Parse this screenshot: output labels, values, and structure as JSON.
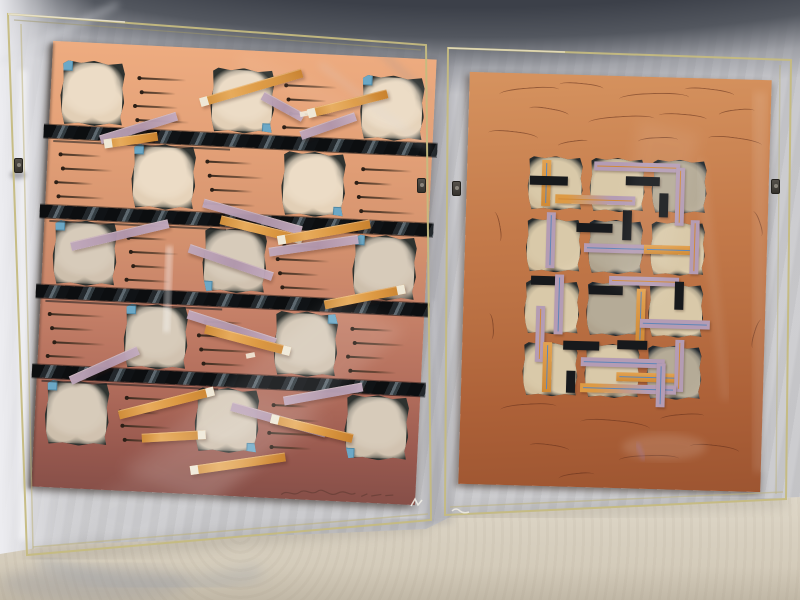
{
  "scene": {
    "description": "Photograph of two abstract mixed-media collage artworks in clear acrylic box frames standing side by side on a cream table against a draped gray fabric backdrop",
    "artwork_count": 2,
    "palette": {
      "fabric": "#c6c6ca",
      "fabric_shadow": "#4a4e56",
      "table": "#d8d0c0",
      "acrylic_edge": "#c5bb80",
      "clip_metal": "#3f3c38"
    }
  },
  "left_artwork": {
    "style": "salmon-to-maroon gradient paper, checkerboard grid of dark textured collage squares with sky-blue corner tabs, four black striped bars, scattered diagonal orange and lavender paper strips, scribbled ink lines",
    "paper_gradient": [
      "#eeac80",
      "#d6946f",
      "#b06c5b",
      "#864f48"
    ],
    "grid": {
      "rows": 5,
      "cols": 5,
      "square_color": "#2e322f",
      "texture_color": "#ecdcc6",
      "pattern": [
        [
          1,
          0,
          1,
          0,
          1
        ],
        [
          0,
          1,
          0,
          1,
          0
        ],
        [
          1,
          0,
          1,
          0,
          1
        ],
        [
          0,
          1,
          0,
          1,
          0
        ],
        [
          1,
          0,
          1,
          0,
          1
        ]
      ]
    },
    "blue_squares": {
      "color": "#6ca8c6",
      "positions": [
        {
          "r": 0,
          "c": 0,
          "corner": "tl"
        },
        {
          "r": 0,
          "c": 2,
          "corner": "br"
        },
        {
          "r": 0,
          "c": 4,
          "corner": "tl"
        },
        {
          "r": 1,
          "c": 1,
          "corner": "tl"
        },
        {
          "r": 1,
          "c": 3,
          "corner": "br"
        },
        {
          "r": 2,
          "c": 0,
          "corner": "tl"
        },
        {
          "r": 2,
          "c": 2,
          "corner": "bl"
        },
        {
          "r": 2,
          "c": 4,
          "corner": "tl"
        },
        {
          "r": 3,
          "c": 1,
          "corner": "tl"
        },
        {
          "r": 3,
          "c": 3,
          "corner": "tr"
        },
        {
          "r": 4,
          "c": 0,
          "corner": "tl"
        },
        {
          "r": 4,
          "c": 2,
          "corner": "br"
        },
        {
          "r": 4,
          "c": 4,
          "corner": "bl"
        }
      ]
    },
    "bars": {
      "count": 4,
      "y": [
        84,
        164,
        244,
        324
      ],
      "colors": [
        "#0c0e10",
        "#5d686f"
      ]
    },
    "strips": [
      {
        "x": 150,
        "y": 50,
        "w": 106,
        "a": -19,
        "c": "o",
        "tip": "l"
      },
      {
        "x": 212,
        "y": 40,
        "w": 46,
        "a": 26,
        "c": "l",
        "tip": null
      },
      {
        "x": 52,
        "y": 92,
        "w": 80,
        "a": -20,
        "c": "l",
        "tip": null
      },
      {
        "x": 56,
        "y": 96,
        "w": 54,
        "a": -11,
        "c": "o",
        "tip": "l"
      },
      {
        "x": 258,
        "y": 56,
        "w": 82,
        "a": -17,
        "c": "o",
        "tip": "l"
      },
      {
        "x": 252,
        "y": 78,
        "w": 58,
        "a": -22,
        "c": "l",
        "tip": null
      },
      {
        "x": 158,
        "y": 150,
        "w": 102,
        "a": 13,
        "c": "l",
        "tip": null
      },
      {
        "x": 176,
        "y": 166,
        "w": 84,
        "a": 11,
        "c": "o",
        "tip": "r"
      },
      {
        "x": 28,
        "y": 200,
        "w": 100,
        "a": -16,
        "c": "l",
        "tip": null
      },
      {
        "x": 146,
        "y": 196,
        "w": 88,
        "a": 16,
        "c": "l",
        "tip": null
      },
      {
        "x": 234,
        "y": 184,
        "w": 94,
        "a": -13,
        "c": "o",
        "tip": "l"
      },
      {
        "x": 226,
        "y": 196,
        "w": 90,
        "a": -11,
        "c": "l",
        "tip": null
      },
      {
        "x": 148,
        "y": 262,
        "w": 92,
        "a": 15,
        "c": "l",
        "tip": null
      },
      {
        "x": 166,
        "y": 276,
        "w": 88,
        "a": 12,
        "c": "o",
        "tip": "r"
      },
      {
        "x": 284,
        "y": 246,
        "w": 82,
        "a": -14,
        "c": "o",
        "tip": "r"
      },
      {
        "x": 34,
        "y": 334,
        "w": 74,
        "a": -27,
        "c": "l",
        "tip": null
      },
      {
        "x": 84,
        "y": 366,
        "w": 98,
        "a": -17,
        "c": "o",
        "tip": "r"
      },
      {
        "x": 196,
        "y": 352,
        "w": 98,
        "a": 13,
        "c": "l",
        "tip": null
      },
      {
        "x": 236,
        "y": 362,
        "w": 84,
        "a": 11,
        "c": "o",
        "tip": "l"
      },
      {
        "x": 108,
        "y": 388,
        "w": 64,
        "a": -6,
        "c": "o",
        "tip": "r"
      },
      {
        "x": 158,
        "y": 418,
        "w": 96,
        "a": -11,
        "c": "o",
        "tip": "l"
      },
      {
        "x": 248,
        "y": 344,
        "w": 80,
        "a": -13,
        "c": "l",
        "tip": null
      }
    ],
    "flecks": [
      {
        "x": 250,
        "y": 58
      },
      {
        "x": 208,
        "y": 302
      }
    ],
    "signature": "illegible pencil signature, lower right"
  },
  "right_artwork": {
    "style": "terracotta paper with scribbled ink arcs; central 3x4 grid of dark textured collage squares woven over with lavender, orange and black strips carrying thin pinstripes",
    "paper_gradient": [
      "#d6935f",
      "#c47a4a",
      "#9d5531"
    ],
    "motif": {
      "cols": 3,
      "rows": 4,
      "cell_color": "#262b2c",
      "texture_color": "#d9c9a9",
      "cell_tones": [
        0,
        0,
        1,
        0,
        1,
        0,
        0,
        1,
        0,
        0,
        0,
        1
      ]
    },
    "strip_colors": {
      "orange": "#dd9a44",
      "lavender": "#b49cb4",
      "black": "#17191c",
      "pin_blue": "#5d86b8",
      "pin_orange": "#d08a3a"
    },
    "strips": [
      {
        "dir": "v",
        "x": 14,
        "y": 4,
        "len": 46,
        "c": "o",
        "line": "b"
      },
      {
        "dir": "h",
        "x": 2,
        "y": 20,
        "len": 38,
        "c": "k",
        "line": null
      },
      {
        "dir": "h",
        "x": 66,
        "y": 4,
        "len": 86,
        "c": "l",
        "line": "o"
      },
      {
        "dir": "h",
        "x": 98,
        "y": 18,
        "len": 34,
        "c": "k",
        "line": null
      },
      {
        "dir": "v",
        "x": 148,
        "y": 8,
        "len": 58,
        "c": "l",
        "line": "o"
      },
      {
        "dir": "v",
        "x": 132,
        "y": 34,
        "len": 24,
        "c": "k",
        "line": null
      },
      {
        "dir": "h",
        "x": 28,
        "y": 38,
        "len": 80,
        "c": "lo",
        "line": "o"
      },
      {
        "dir": "v",
        "x": 20,
        "y": 56,
        "len": 56,
        "c": "l",
        "line": "b"
      },
      {
        "dir": "h",
        "x": 50,
        "y": 66,
        "len": 36,
        "c": "k",
        "line": null
      },
      {
        "dir": "v",
        "x": 96,
        "y": 52,
        "len": 30,
        "c": "k",
        "line": null
      },
      {
        "dir": "h",
        "x": 58,
        "y": 86,
        "len": 78,
        "c": "l",
        "line": "b"
      },
      {
        "dir": "h",
        "x": 118,
        "y": 86,
        "len": 54,
        "c": "o",
        "line": "b"
      },
      {
        "dir": "v",
        "x": 164,
        "y": 60,
        "len": 54,
        "c": "l",
        "line": "o"
      },
      {
        "dir": "h",
        "x": 6,
        "y": 120,
        "len": 30,
        "c": "k",
        "line": null
      },
      {
        "dir": "v",
        "x": 30,
        "y": 118,
        "len": 60,
        "c": "l",
        "line": "b"
      },
      {
        "dir": "h",
        "x": 64,
        "y": 128,
        "len": 34,
        "c": "k",
        "line": null
      },
      {
        "dir": "h",
        "x": 84,
        "y": 118,
        "len": 70,
        "c": "l",
        "line": "o"
      },
      {
        "dir": "v",
        "x": 112,
        "y": 130,
        "len": 54,
        "c": "o",
        "line": "b"
      },
      {
        "dir": "v",
        "x": 150,
        "y": 122,
        "len": 28,
        "c": "k",
        "line": null
      },
      {
        "dir": "h",
        "x": 116,
        "y": 160,
        "len": 70,
        "c": "l",
        "line": "b"
      },
      {
        "dir": "v",
        "x": 12,
        "y": 150,
        "len": 56,
        "c": "l",
        "line": "o"
      },
      {
        "dir": "h",
        "x": 40,
        "y": 184,
        "len": 36,
        "c": "k",
        "line": null
      },
      {
        "dir": "v",
        "x": 20,
        "y": 186,
        "len": 50,
        "c": "o",
        "line": "b"
      },
      {
        "dir": "h",
        "x": 58,
        "y": 200,
        "len": 84,
        "c": "l",
        "line": "b"
      },
      {
        "dir": "h",
        "x": 94,
        "y": 214,
        "len": 64,
        "c": "o",
        "line": "b"
      },
      {
        "dir": "v",
        "x": 152,
        "y": 180,
        "len": 52,
        "c": "l",
        "line": "o"
      },
      {
        "dir": "h",
        "x": 94,
        "y": 182,
        "len": 30,
        "c": "k",
        "line": null
      },
      {
        "dir": "h",
        "x": 58,
        "y": 226,
        "len": 96,
        "c": "lo",
        "line": "b"
      },
      {
        "dir": "v",
        "x": 44,
        "y": 214,
        "len": 22,
        "c": "k",
        "line": null
      },
      {
        "dir": "v",
        "x": 134,
        "y": 204,
        "len": 44,
        "c": "l",
        "line": "b"
      }
    ],
    "scribbles": {
      "color": "rgba(92,44,26,0.55)",
      "marks": [
        {
          "x": 30,
          "y": 14,
          "w": 60,
          "h": 10,
          "r": -6
        },
        {
          "x": 90,
          "y": 8,
          "w": 44,
          "h": 8,
          "r": 4
        },
        {
          "x": 150,
          "y": 16,
          "w": 70,
          "h": 12,
          "r": -3
        },
        {
          "x": 215,
          "y": 10,
          "w": 50,
          "h": 9,
          "r": 5
        },
        {
          "x": 60,
          "y": 34,
          "w": 40,
          "h": 8,
          "r": 8
        },
        {
          "x": 120,
          "y": 40,
          "w": 66,
          "h": 10,
          "r": -5
        },
        {
          "x": 190,
          "y": 36,
          "w": 48,
          "h": 8,
          "r": 3
        },
        {
          "x": 250,
          "y": 30,
          "w": 36,
          "h": 8,
          "r": -8
        },
        {
          "x": 20,
          "y": 58,
          "w": 50,
          "h": 10,
          "r": 5
        },
        {
          "x": 170,
          "y": 60,
          "w": 40,
          "h": 8,
          "r": -4
        },
        {
          "x": 240,
          "y": 58,
          "w": 54,
          "h": 10,
          "r": 6
        },
        {
          "x": 90,
          "y": 66,
          "w": 30,
          "h": 6,
          "r": -10
        },
        {
          "x": 16,
          "y": 150,
          "w": 30,
          "h": 8,
          "r": 78
        },
        {
          "x": 278,
          "y": 140,
          "w": 26,
          "h": 8,
          "r": 70
        },
        {
          "x": 14,
          "y": 250,
          "w": 26,
          "h": 8,
          "r": 84
        },
        {
          "x": 280,
          "y": 250,
          "w": 30,
          "h": 8,
          "r": -75
        },
        {
          "x": 40,
          "y": 330,
          "w": 56,
          "h": 10,
          "r": -5
        },
        {
          "x": 120,
          "y": 344,
          "w": 70,
          "h": 12,
          "r": 4
        },
        {
          "x": 200,
          "y": 336,
          "w": 44,
          "h": 8,
          "r": -6
        },
        {
          "x": 70,
          "y": 370,
          "w": 40,
          "h": 8,
          "r": 6
        },
        {
          "x": 160,
          "y": 378,
          "w": 60,
          "h": 10,
          "r": -3
        },
        {
          "x": 230,
          "y": 366,
          "w": 50,
          "h": 10,
          "r": 5
        },
        {
          "x": 100,
          "y": 398,
          "w": 36,
          "h": 8,
          "r": -8
        }
      ]
    }
  },
  "hardware": {
    "clips": [
      {
        "x": 14,
        "y": 158,
        "side": "left-frame-left-edge"
      },
      {
        "x": 417,
        "y": 178,
        "side": "left-frame-right-edge"
      },
      {
        "x": 452,
        "y": 181,
        "side": "right-frame-left-edge"
      },
      {
        "x": 771,
        "y": 179,
        "side": "right-frame-right-edge"
      }
    ]
  }
}
